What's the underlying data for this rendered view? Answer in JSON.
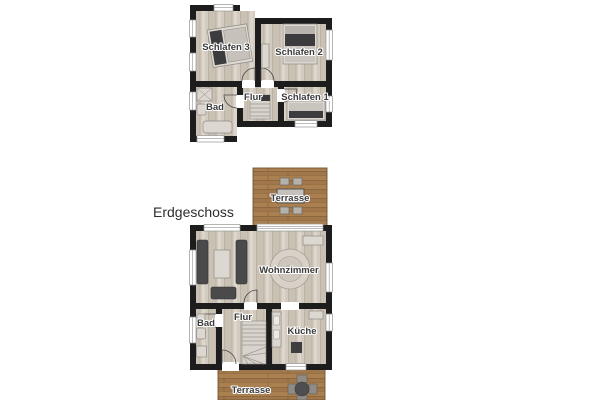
{
  "colors": {
    "background": "#ffffff",
    "wall": "#1d1d1d",
    "floor_wood": "#d2cabf",
    "deck_wood": "#aa7f4f",
    "furniture_dark": "#4a4a4d",
    "furniture_light": "#dcd8d1",
    "label_text": "#3b3b3b"
  },
  "ground_floor": {
    "title": "Erdgeschoss",
    "terrace_top": {
      "label": "Terrasse"
    },
    "terrace_bottom": {
      "label": "Terrasse"
    },
    "rooms": {
      "wohnzimmer": {
        "label": "Wohnzimmer"
      },
      "kueche": {
        "label": "Küche"
      },
      "flur": {
        "label": "Flur"
      },
      "bad": {
        "label": "Bad"
      }
    }
  },
  "upper_floor": {
    "rooms": {
      "schlafen1": {
        "label": "Schlafen 1"
      },
      "schlafen2": {
        "label": "Schlafen 2"
      },
      "schlafen3": {
        "label": "Schlafen 3"
      },
      "flur": {
        "label": "Flur"
      },
      "bad": {
        "label": "Bad"
      }
    }
  }
}
